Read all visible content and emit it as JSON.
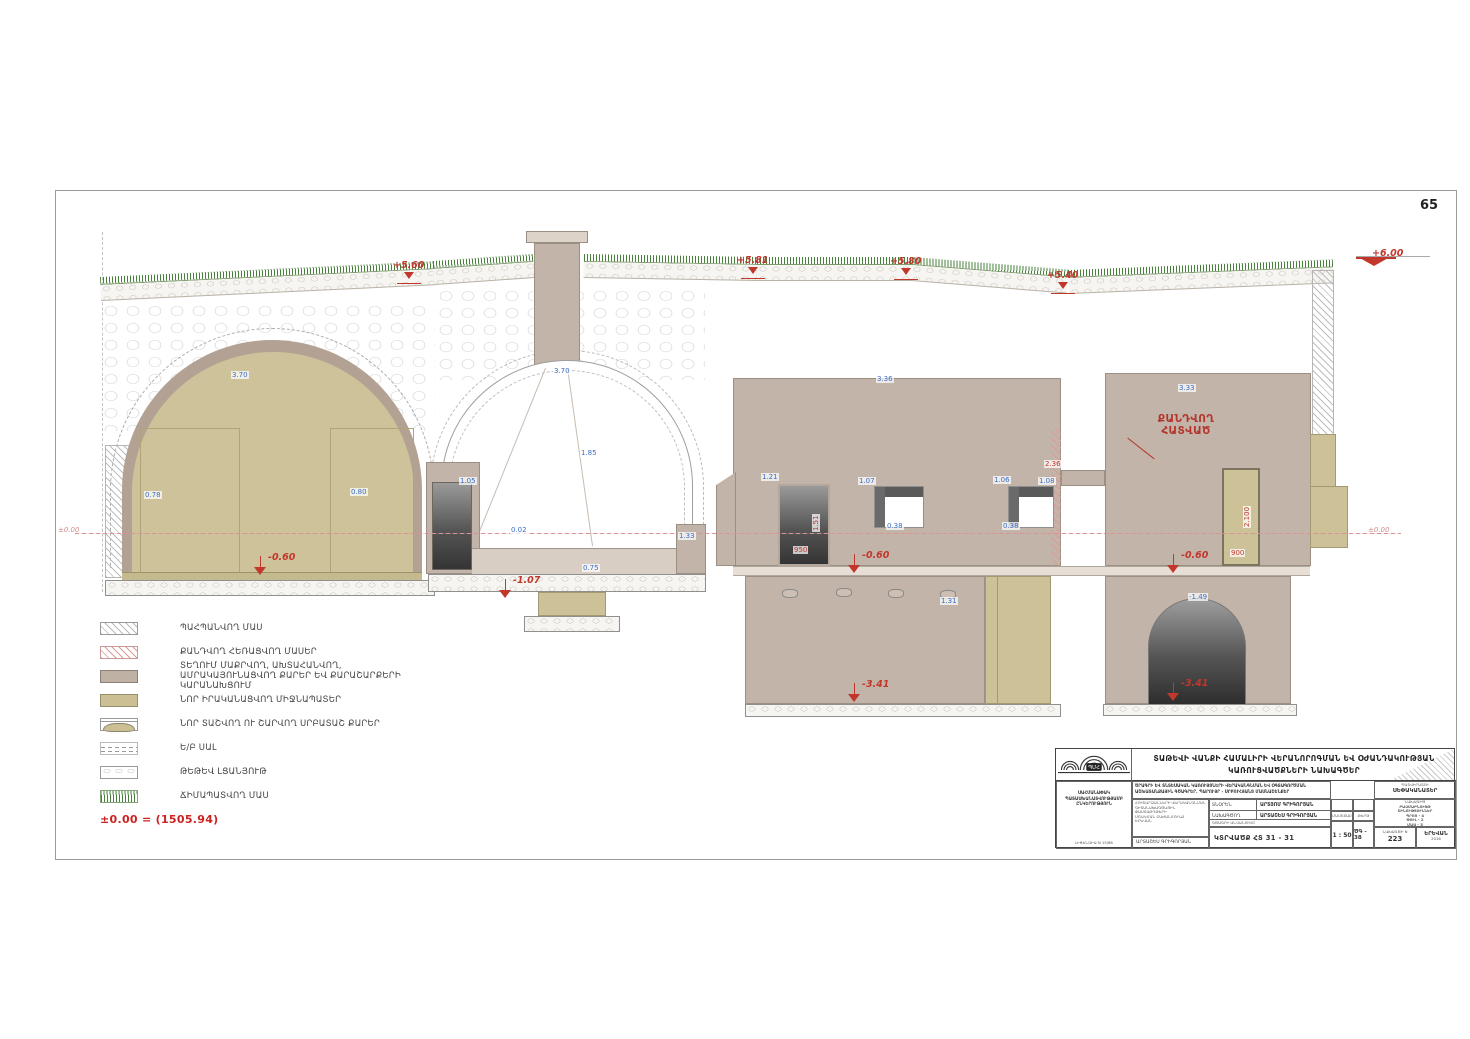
{
  "page": {
    "number": "65"
  },
  "datum": {
    "left": "±0.00",
    "right": "±0.00",
    "note": "±0.00 = (1505.94)"
  },
  "annotation": {
    "line1": "ՔԱՆԴՎՈՂ",
    "line2": "ՀԱՏՎԱԾ"
  },
  "levels": [
    {
      "t": "+5.60",
      "x": 393,
      "y": 253,
      "kind": "roof"
    },
    {
      "t": "+5.81",
      "x": 737,
      "y": 248,
      "kind": "roof"
    },
    {
      "t": "+5.80",
      "x": 890,
      "y": 249,
      "kind": "roof"
    },
    {
      "t": "+5.40",
      "x": 1047,
      "y": 263,
      "kind": "roof"
    },
    {
      "t": "+6.00",
      "x": 1372,
      "y": 241,
      "kind": "datum6"
    },
    {
      "t": "-0.60",
      "x": 268,
      "y": 545,
      "kind": "down"
    },
    {
      "t": "-1.07",
      "x": 513,
      "y": 568,
      "kind": "down"
    },
    {
      "t": "-0.60",
      "x": 862,
      "y": 543,
      "kind": "down"
    },
    {
      "t": "-0.60",
      "x": 1181,
      "y": 543,
      "kind": "down"
    },
    {
      "t": "-3.41",
      "x": 862,
      "y": 672,
      "kind": "down"
    },
    {
      "t": "-3.41",
      "x": 1181,
      "y": 671,
      "kind": "down"
    }
  ],
  "dims": [
    {
      "t": "3.70",
      "x": 231,
      "y": 371
    },
    {
      "t": "3.70",
      "x": 553,
      "y": 367
    },
    {
      "t": "0.78",
      "x": 144,
      "y": 491
    },
    {
      "t": "0.80",
      "x": 350,
      "y": 488
    },
    {
      "t": "1.05",
      "x": 459,
      "y": 477
    },
    {
      "t": "1.85",
      "x": 580,
      "y": 449
    },
    {
      "t": "0.02",
      "x": 510,
      "y": 526
    },
    {
      "t": "0.75",
      "x": 582,
      "y": 564
    },
    {
      "t": "1.33",
      "x": 678,
      "y": 532
    },
    {
      "t": "3.36",
      "x": 876,
      "y": 375
    },
    {
      "t": "1.21",
      "x": 761,
      "y": 473
    },
    {
      "t": "1.07",
      "x": 858,
      "y": 477
    },
    {
      "t": "0.38",
      "x": 886,
      "y": 522
    },
    {
      "t": "1.06",
      "x": 993,
      "y": 476
    },
    {
      "t": "1.08",
      "x": 1038,
      "y": 477
    },
    {
      "t": "0.38",
      "x": 1002,
      "y": 522
    },
    {
      "t": "3.33",
      "x": 1178,
      "y": 384
    },
    {
      "t": "-1.49",
      "x": 1188,
      "y": 593
    },
    {
      "t": "1.31",
      "x": 940,
      "y": 597
    },
    {
      "t": "2.36",
      "x": 1044,
      "y": 460,
      "c": "red"
    },
    {
      "t": "950",
      "x": 793,
      "y": 546,
      "c": "red"
    },
    {
      "t": "1.51",
      "x": 812,
      "y": 532,
      "c": "red",
      "r": -90
    },
    {
      "t": "2.100",
      "x": 1243,
      "y": 528,
      "c": "red",
      "r": -90
    },
    {
      "t": "900",
      "x": 1230,
      "y": 549,
      "c": "red"
    }
  ],
  "legend": {
    "items": [
      {
        "label": "ՊԱՀՊԱՆՎՈՂ ՄԱՍ",
        "swatch": "hatch-gray"
      },
      {
        "label": "ՔԱՆԴՎՈՂ ՀԵՌԱՑՎՈՂ ՄԱՍԵՐ",
        "swatch": "hatch-red"
      },
      {
        "label": "ՏԵՂՈՒՄ ՄԱՔՐՎՈՂ, ԱԽՏԱՀԱՆՎՈՂ, ԱՄՐԱԿԱՅՈՒՆԱՑՎՈՂ ՔԱՐԵՐ ԵՎ ՔԱՐԱՇԱՐՔԵՐԻ ԿԱՐԱՆԱԽՑՈՒՄ",
        "swatch": "solid-taupe"
      },
      {
        "label": "ՆՈՐ ԻՐԱԿԱՆԱՑՎՈՂ ՄԻՋՆԱՊԱՏԵՐ",
        "swatch": "solid-khaki"
      },
      {
        "label": "ՆՈՐ ՏԱՇՎՈՂ ՈՒ ՇԱՐՎՈՂ ՍՐԲԱՏԱՇ ՔԱՐԵՐ",
        "swatch": "stone"
      },
      {
        "label": "Ե/Բ ՍԱԼ",
        "swatch": "dashed"
      },
      {
        "label": "ԹԵԹԵՎ ԼՑԱՆՅՈՒԹ",
        "swatch": "rubble"
      },
      {
        "label": "ՃԻՄԱՊԱՏՎՈՂ ՄԱՍ",
        "swatch": "grass"
      }
    ]
  },
  "titleblock": {
    "header1": "ՏԱԹԵՎԻ ՎԱՆՔԻ ՀԱՄԱԼԻՐԻ ՎԵՐԱՆՈՐՈԳՄԱՆ ԵՎ ՕԺԱՆԴԱԿՈՒԹՅԱՆ",
    "header2": "ԿԱՌՈՒՑՎԱԾՔՆԵՐԻ ՆԱԽԱԳԾԵՐ",
    "logo_text": "ՊՄՀ",
    "org_lines": [
      "ՍԱՀՄԱՆԱՓԱԿ",
      "ՊԱՏԱՍԽԱՆԱՏՎՈՒԹՅԱՄԲ",
      "ԸՆԿԵՐՈՒԹՅՈՒՆ"
    ],
    "license": "ԼԻՑԵՆԶԻԱ N 15/68",
    "desc1": "ԾՐԱԳՐԻ ԵՎ ՏՆՏԵՍԱԿԱՆ ԿԱՌՈՒՅՑՆԵՐԻ ՎԵՐԱԿԱՆԳՆՄԱՆ ԵՎ ՕԳՏԱԳՈՐԾՄԱՆ",
    "desc2": "ԱՇԽԱՏԱՆՔԱՅԻՆ ԳԾԱԳՐԵՐ. ՊԱՐՈՒՅՐ - ՍՐԲՈՒՀՅԱՆՑ ՄԱՍՆԱՇԵՆՔԵՐ",
    "sub_lines": [
      "ՀՈՒՇԱՐՁԱՆՆԵՐԻ ՎԵՐԱԿԱՆԳՆՄԱՆ",
      "ԳԻՏԱՆԱԽԱԳԾԱՅԻՆ ՓԱՍՏԱԹՂԹԵՐԻ",
      "ՄՇԱԿՄԱՆ ԲԱԺԱՆՄՈՒՆՔ",
      "ԵՐԵՎԱՆ"
    ],
    "rows": [
      {
        "role": "ՏՆՕՐԵՆ",
        "name": "ԱՐՏՅՈՄ ԳՐԻԳՈՐՅԱՆ"
      },
      {
        "role": "ՆԱԽԱԳԾՈՂ",
        "name": "ԱՐՏԱՇԵՍ ԳՐԻԳՈՐՅԱՆ"
      }
    ],
    "author": "ԱՐՏԱՇԵՍ ԳՐԻԳՈՐՅԱՆ",
    "drawing_label": "ԳԾԱԳՐԻ ԱՆՎԱՆՈՒՄԸ",
    "drawing_name": "ԿՏՐՎԱԾՔ ՀՏ 31 - 31",
    "scale_label": "ՄԱՍՇՏԱԲ",
    "scale": "1 : 50",
    "sheet_label": "ԹԵՐԹ",
    "sheet": "ԾԳ - 38",
    "owner_label": "ՊԱՏՎԻՐԱՏՈՒ",
    "owner": "ՍԵՓԱԿԱՆԱՏԵՐ",
    "proj_label": "ՆԱԽԱԳԻԾ",
    "proj_lines": [
      "ԲԱԶՄԱԲՆՈՒՅԹ",
      "ՇԻՆՈՒԹՅՈՒՆՆԵՐ",
      "ՊՐՈՅ - 4",
      "ՓՈՒԼ - 2",
      "ՄԱՍ - 3"
    ],
    "number_label": "ՆԱԽԱԳԾԻ N",
    "number": "223",
    "city": "ԵՐԵՎԱՆ",
    "year": "2016"
  }
}
